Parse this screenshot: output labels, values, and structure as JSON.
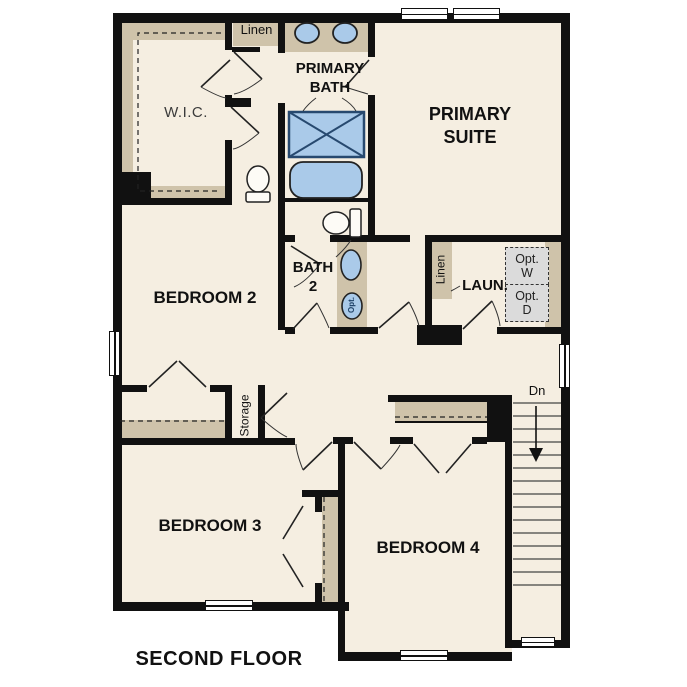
{
  "title": "SECOND FLOOR",
  "rooms": {
    "wic": "W.I.C.",
    "primary_bath": "PRIMARY\nBATH",
    "primary_suite": "PRIMARY\nSUITE",
    "bedroom2": "BEDROOM 2",
    "bath2": "BATH\n2",
    "laundry": "LAUN.",
    "bedroom3": "BEDROOM 3",
    "bedroom4": "BEDROOM 4"
  },
  "closets": {
    "linen_top": "Linen",
    "linen_laundry": "Linen",
    "storage": "Storage",
    "opt_washer": "Opt.\nW",
    "opt_dryer": "Opt.\nD"
  },
  "fixtures": {
    "optional_sink": "Opt."
  },
  "stairs": {
    "down_label": "Dn"
  },
  "colors": {
    "floor": "#f5eee1",
    "wall": "#111111",
    "cabinet_tan": "#cfc3aa",
    "fixture_blue": "#aacae9",
    "fixture_stroke": "#27496f",
    "optional_gray": "#dbdbdb"
  }
}
